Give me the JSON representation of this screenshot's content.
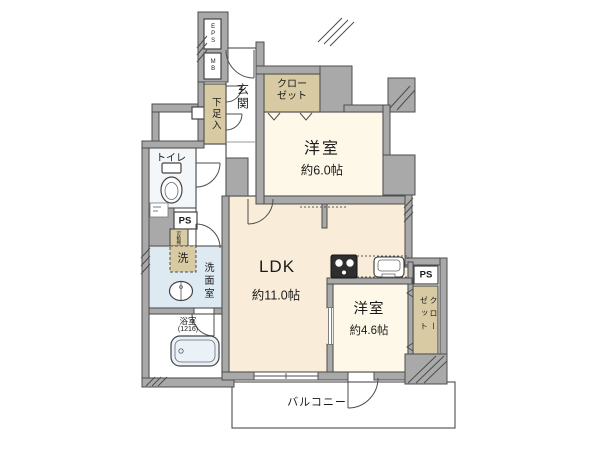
{
  "colors": {
    "wall": "#a9a9a9",
    "outline": "#4d4d4d",
    "bedroom": "#fdf8e7",
    "ldk": "#f9edd9",
    "storage": "#d8cba4",
    "wet": "#ddeaf2",
    "toilet_floor": "#f3f7fa",
    "bath_floor": "#ffffff",
    "balcony": "#ffffff"
  },
  "labels": {
    "eps": "EPS",
    "mb": "MB",
    "entrance": "玄関",
    "shoe_cabinet": "下足入",
    "closet_top": "クローゼット",
    "closet_right": "クローゼット",
    "bedroom1_name": "洋室",
    "bedroom1_size": "約6.0帖",
    "ldk_name": "LDK",
    "ldk_size": "約11.0帖",
    "bedroom2_name": "洋室",
    "bedroom2_size": "約4.6帖",
    "toilet": "トイレ",
    "ps_left": "PS",
    "ps_right": "PS",
    "movable_shelf": "可動棚",
    "washer": "洗",
    "washroom": "洗面室",
    "bath_name": "浴室",
    "bath_size": "(1216)",
    "balcony": "バルコニー"
  }
}
